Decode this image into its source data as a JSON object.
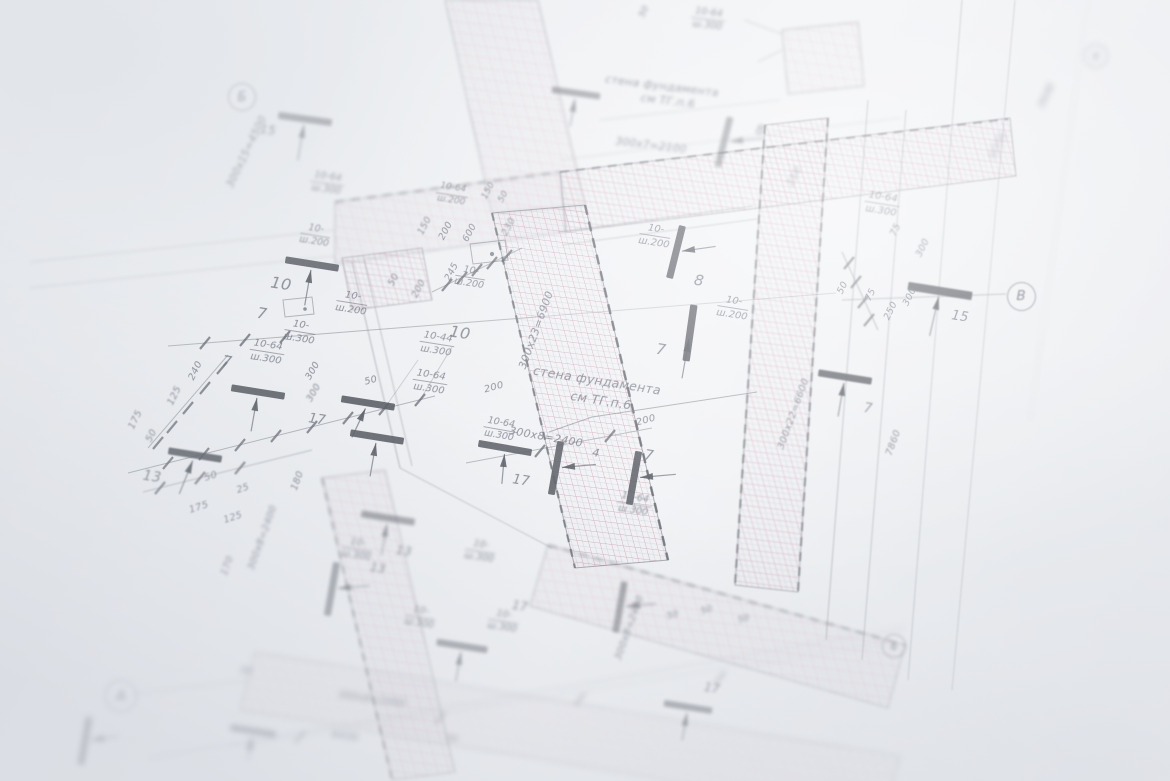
{
  "texts": {
    "note1": "стена фундамента",
    "note2": "см ТГ.п.6",
    "d6900": "300х23=6900",
    "d6600": "300х22=6600",
    "d4500": "300х15=4500",
    "d2400": "300х8=2400",
    "d2100": "300х7=2100",
    "d7860": "7860",
    "d6775": "6775",
    "d2640": "2640",
    "d6430": "6430",
    "d600": "600",
    "d250": "250",
    "d245": "245",
    "d240": "240",
    "d230": "230",
    "d210": "210",
    "d200": "200",
    "d180": "180",
    "d175": "175",
    "d170": "170",
    "d150": "150",
    "d125": "125",
    "d300": "300",
    "d75": "75",
    "d50": "50",
    "d25": "25",
    "r10": "10-",
    "r1044": "10-44",
    "r1064": "10-64",
    "sh200": "ш.200",
    "sh300": "ш.300",
    "n4": "4",
    "n7": "7",
    "n8": "8",
    "n10": "10",
    "n13": "13",
    "n15": "15",
    "n17": "17",
    "axA": "А",
    "axB": "Б",
    "axV": "В",
    "ax6": "6"
  }
}
